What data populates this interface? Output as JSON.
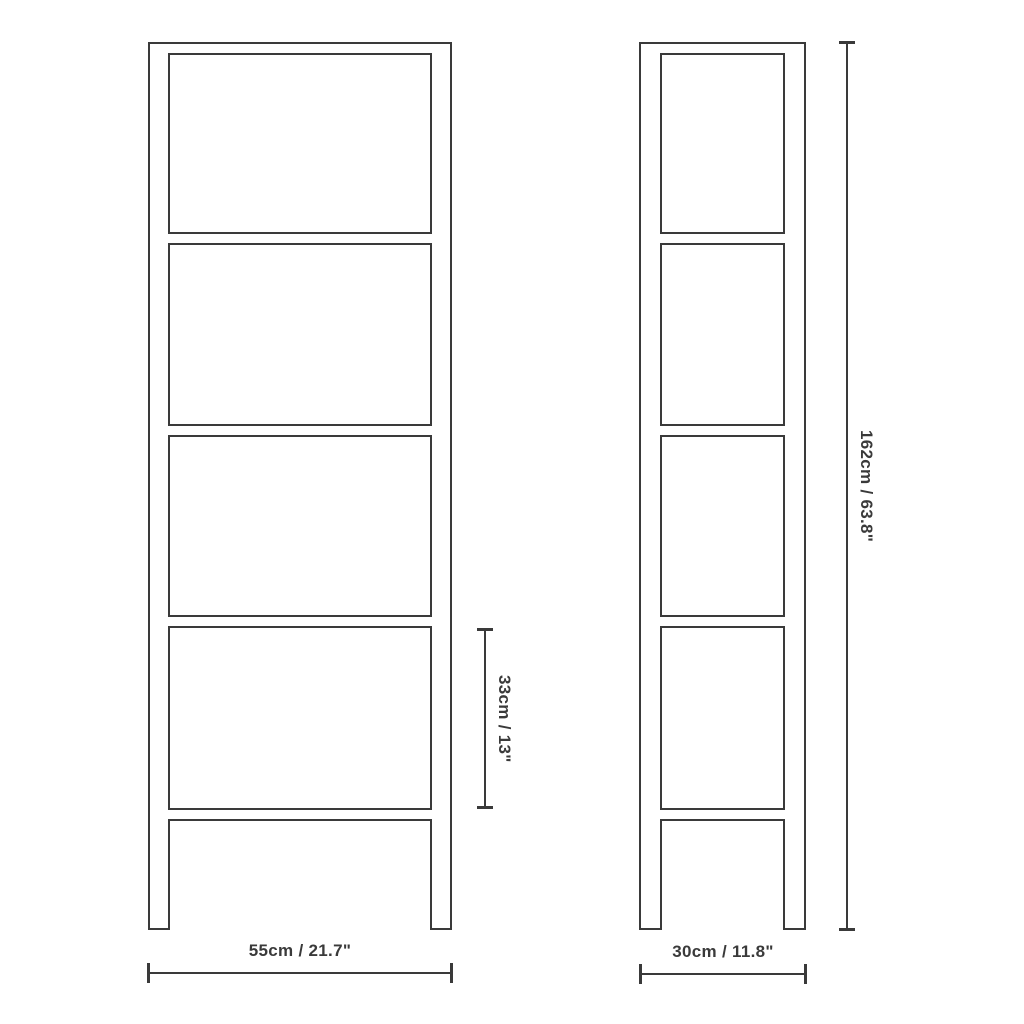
{
  "diagram": {
    "subject": "shelf-unit-dimension-drawing",
    "views": {
      "front": {
        "name": "front-view",
        "shelf_count": 5
      },
      "side": {
        "name": "side-view",
        "shelf_count": 5
      }
    },
    "dimensions": {
      "width": "55cm / 21.7\"",
      "depth": "30cm / 11.8\"",
      "height": "162cm / 63.8\"",
      "shelf_spacing": "33cm / 13\""
    },
    "colors": {
      "line": "#3a3a3a",
      "background": "#ffffff",
      "text": "#3a3a3a"
    }
  }
}
